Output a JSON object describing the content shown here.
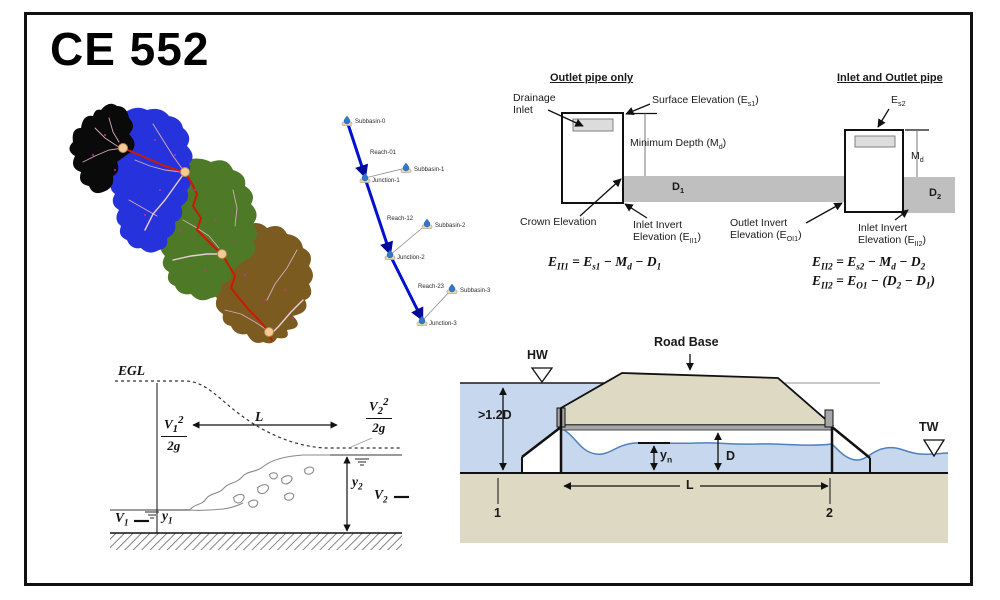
{
  "slide": {
    "title": "CE 552"
  },
  "colors": {
    "ink": "#111111",
    "basin_black": "#0a0a0a",
    "basin_blue": "#2633dd",
    "basin_green": "#4e7a27",
    "basin_brown": "#7c5b21",
    "river_red": "#cc1a00",
    "tributary_pink": "#d9a8bd",
    "tributary_pale": "#e9cdd9",
    "node_tan": "#f4cb96",
    "reach_blue": "#0010cc",
    "connector_gray": "#8a8a8a",
    "pipe_gray": "#bfbfbf",
    "grate_gray": "#dcdcdc",
    "deck_gray": "#a6a6a6",
    "water_blue": "#c7d7ed",
    "water_line_blue": "#4f81bd",
    "ground_tan": "#ddd9c3"
  },
  "hms": {
    "subbasin0": "Subbasin-0",
    "reach01": "Reach-01",
    "junction1": "Junction-1",
    "subbasin1": "Subbasin-1",
    "reach12": "Reach-12",
    "junction2": "Junction-2",
    "subbasin2": "Subbasin-2",
    "reach23": "Reach-23",
    "junction3": "Junction-3",
    "subbasin3": "Subbasin-3"
  },
  "inlet": {
    "title_left": "Outlet pipe only",
    "title_right": "Inlet and Outlet pipe",
    "drainage_inlet": "Drainage<br>Inlet",
    "surface_elev": "Surface Elevation (E<sub>s1</sub>)",
    "min_depth": "Minimum Depth (M<sub>d</sub>)",
    "d1": "D<sub>1</sub>",
    "crown": "Crown Elevation",
    "inlet_invert1": "Inlet Invert<br>Elevation (E<sub>II1</sub>)",
    "eq1": "E<sub>II1</sub> = E<sub>s1</sub> − M<sub>d</sub> − D<sub>1</sub>",
    "es2": "E<sub>s2</sub>",
    "md2": "M<sub>d</sub>",
    "d2": "D<sub>2</sub>",
    "outlet_invert": "Outlet Invert<br>Elevation (E<sub>OI1</sub>)",
    "inlet_invert2": "Inlet Invert<br>Elevation (E<sub>II2</sub>)",
    "eq2": "E<sub>II2</sub> = E<sub>s2</sub> − M<sub>d</sub> − D<sub>2</sub>",
    "eq3": "E<sub>II2</sub> = E<sub>O1</sub> − (D<sub>2</sub> − D<sub>1</sub>)"
  },
  "egl": {
    "egl": "EGL",
    "v1_num": "V<sub>1</sub><sup>2</sup>",
    "v1_den": "2g",
    "v2_num": "V<sub>2</sub><sup>2</sup>",
    "v2_den": "2g",
    "length": "L",
    "y1": "y<sub>1</sub>",
    "y2": "y<sub>2</sub>",
    "v1": "V<sub>1</sub>",
    "v2": "V<sub>2</sub>"
  },
  "culvert": {
    "hw": "HW",
    "tw": "TW",
    "road_base": "Road Base",
    "depth_req": ">1.2D",
    "yn": "y<sub>n</sub>",
    "d": "D",
    "length": "L",
    "section1": "1",
    "section2": "2"
  }
}
